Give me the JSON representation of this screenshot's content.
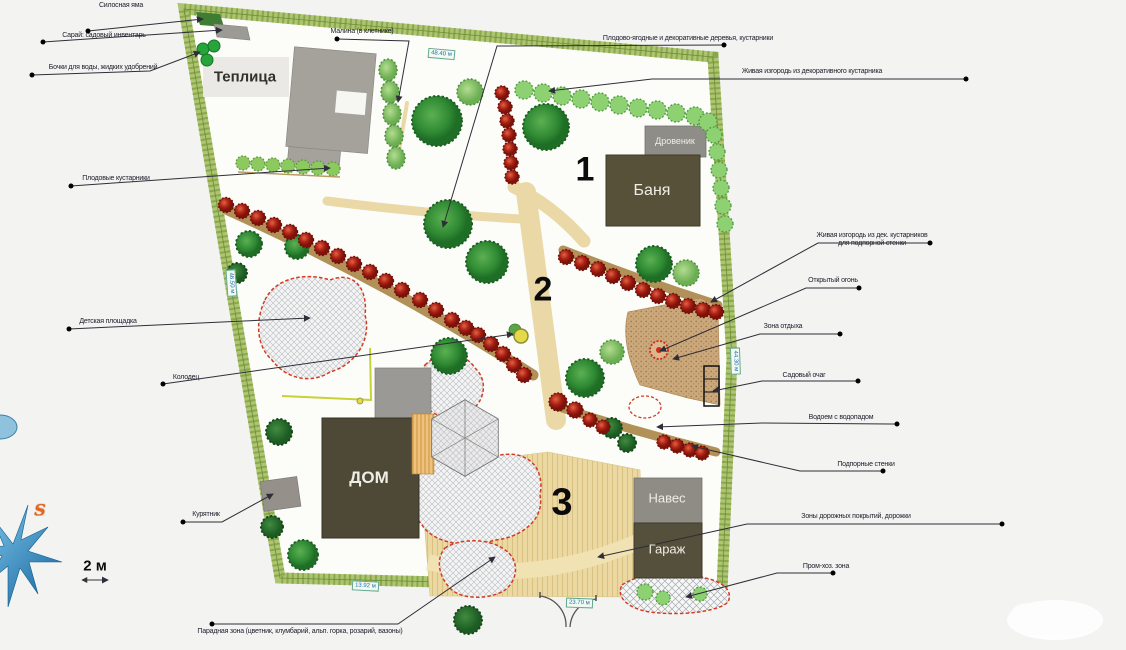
{
  "plan": {
    "buildings": {
      "greenhouse": "Теплица",
      "woodshed": "Дровеник",
      "bathhouse": "Баня",
      "house": "ДОМ",
      "canopy": "Навес",
      "garage": "Гараж"
    },
    "zone_numbers": [
      "1",
      "2",
      "3"
    ],
    "measurements": {
      "top": "48.40 м",
      "left": "46.50 м",
      "right": "44.30 м",
      "bottom_left": "13.92 м",
      "bottom_gate": "23.70 м"
    },
    "scale_label": "2 м",
    "compass_letter": "S",
    "colors": {
      "accent_red": "#d23b23",
      "tree_green": "#2f8a33",
      "hedge_green": "#8ed173",
      "building_dark": "#4e4937",
      "building_gray": "#8f8d87",
      "path_sand": "#ead9a6",
      "compass_blue": "#1b6fae"
    }
  },
  "callouts": [
    {
      "text": "Силосная яма"
    },
    {
      "text": "Сарай: садовый инвентарь"
    },
    {
      "text": "Бочки для воды, жидких удобрений"
    },
    {
      "text": "Плодовые кустарники"
    },
    {
      "text": "Детская площадка"
    },
    {
      "text": "Колодец"
    },
    {
      "text": "Курятник"
    },
    {
      "text": "Малина (в клетнике)"
    },
    {
      "text": "Плодово-ягодные и декоративные деревья, кустарники"
    },
    {
      "text": "Живая изгородь из декоративного кустарника"
    },
    {
      "text": "Живая изгородь  из дек. кустарников\nдля подпорной стенки"
    },
    {
      "text": "Открытый огонь"
    },
    {
      "text": "Зона отдыха"
    },
    {
      "text": "Садовый очаг"
    },
    {
      "text": "Водоем с водопадом"
    },
    {
      "text": "Подпорные стенки"
    },
    {
      "text": "Зоны дорожных покрытий, дорожки"
    },
    {
      "text": "Пром-хоз. зона"
    },
    {
      "text": "Парадная зона (цветник, клумбарий, альп. горка, розарий, вазоны)"
    }
  ]
}
